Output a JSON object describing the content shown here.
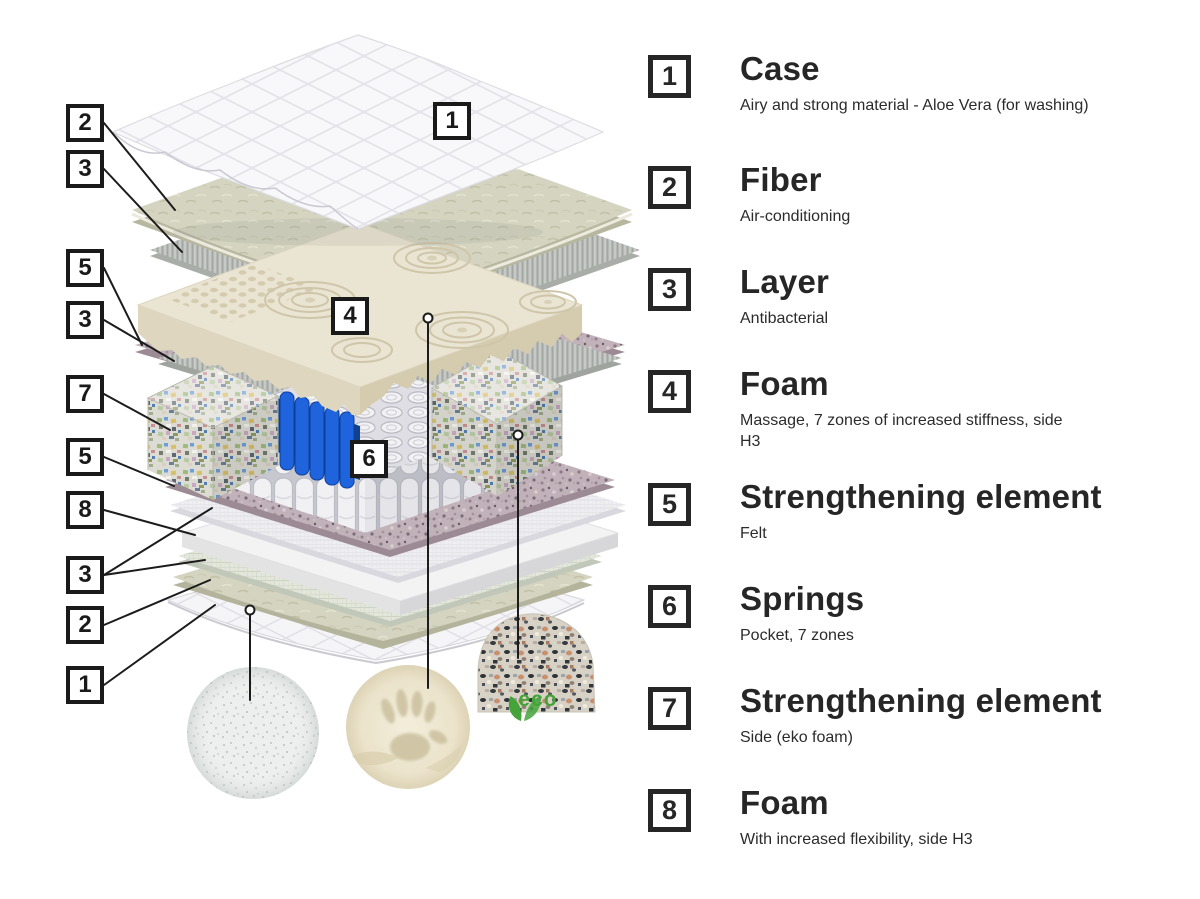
{
  "diagram": {
    "left_callouts": [
      "2",
      "3",
      "5",
      "3",
      "7",
      "5",
      "8",
      "3",
      "2",
      "1"
    ],
    "inner_callouts": [
      "1",
      "4",
      "6"
    ],
    "eco_label": "eco"
  },
  "legend": {
    "items": [
      {
        "number": "1",
        "title": "Case",
        "description": "Airy and strong material - Aloe Vera (for washing)"
      },
      {
        "number": "2",
        "title": "Fiber",
        "description": "Air-conditioning"
      },
      {
        "number": "3",
        "title": "Layer",
        "description": "Antibacterial"
      },
      {
        "number": "4",
        "title": "Foam",
        "description": "Massage, 7 zones of increased stiffness, side H3"
      },
      {
        "number": "5",
        "title": "Strengthening element",
        "description": "Felt"
      },
      {
        "number": "6",
        "title": "Springs",
        "description": "Pocket, 7 zones"
      },
      {
        "number": "7",
        "title": "Strengthening element",
        "description": "Side (eko foam)"
      },
      {
        "number": "8",
        "title": "Foam",
        "description": "With increased flexibility, side H3"
      }
    ]
  },
  "colors": {
    "spring_blue": "#1f64dd",
    "eco_green": "#44a339",
    "outline": "#1c1c1c"
  }
}
